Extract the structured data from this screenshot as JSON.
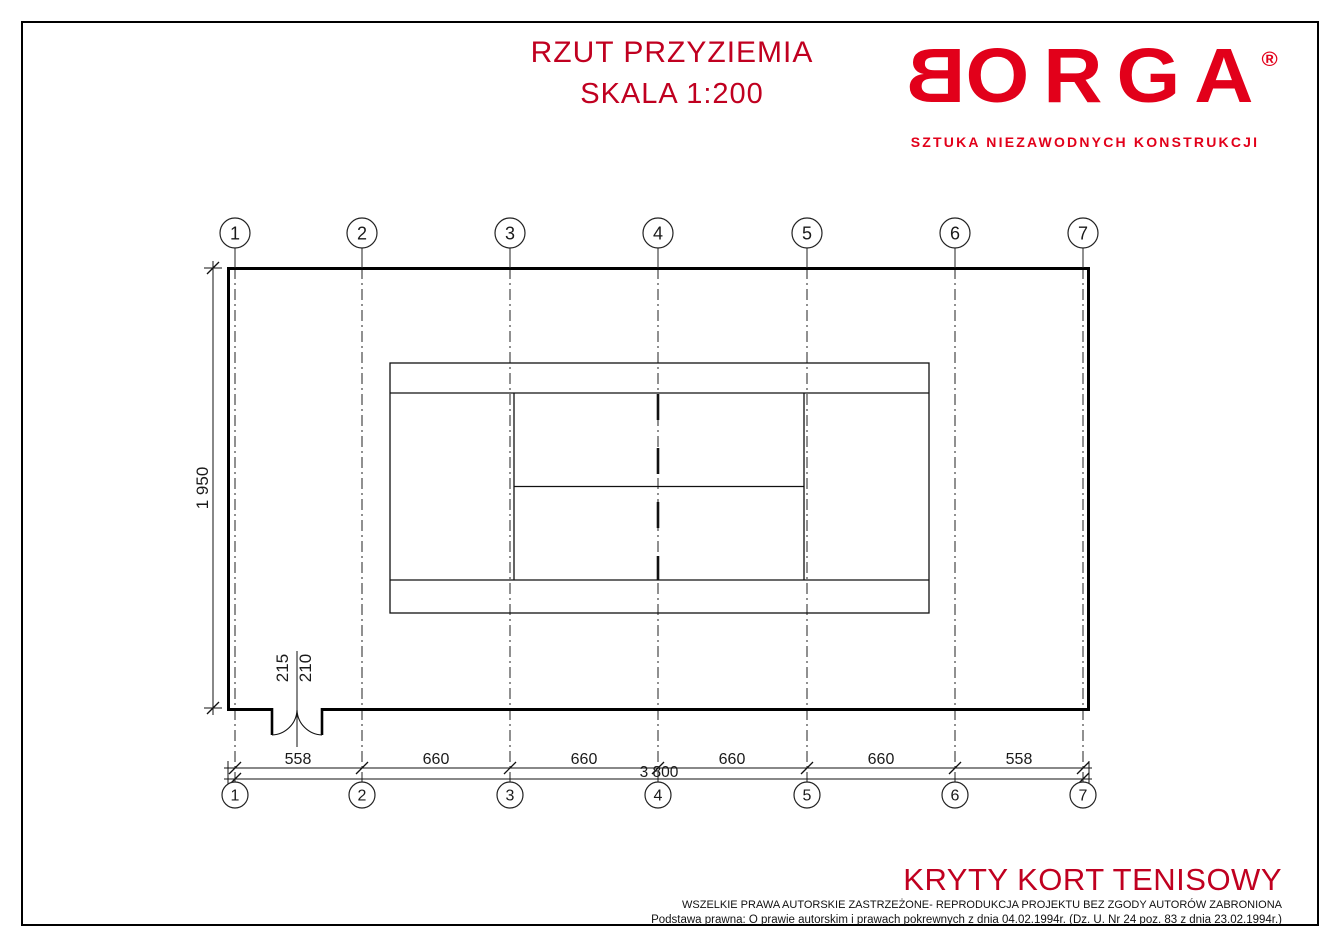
{
  "title": {
    "line1": "RZUT PRZYZIEMIA",
    "line2": "SKALA 1:200"
  },
  "logo": {
    "letter_first": "B",
    "letters_rest": "ORGA",
    "registered": "®",
    "tagline": "SZTUKA NIEZAWODNYCH KONSTRUKCJI",
    "color": "#E2001A"
  },
  "plan": {
    "grid_labels": [
      "1",
      "2",
      "3",
      "4",
      "5",
      "6",
      "7"
    ],
    "dim_segments": [
      "558",
      "660",
      "660",
      "660",
      "660",
      "558"
    ],
    "dim_total": "3 800",
    "dim_height": "1 950",
    "door_dim_width": "215",
    "door_dim_clear": "210"
  },
  "footer": {
    "project": "KRYTY KORT TENISOWY",
    "rights": "WSZELKIE PRAWA AUTORSKIE ZASTRZEŻONE- REPRODUKCJA PROJEKTU BEZ ZGODY AUTORÓW ZABRONIONA",
    "legal": "Podstawa prawna: O prawie autorskim i prawach pokrewnych z dnia 04.02.1994r. (Dz. U. Nr 24 poz. 83 z dnia 23.02.1994r.)"
  },
  "colors": {
    "accent_red": "#C00020",
    "logo_red": "#E2001A",
    "ink": "#1A1A1A"
  }
}
